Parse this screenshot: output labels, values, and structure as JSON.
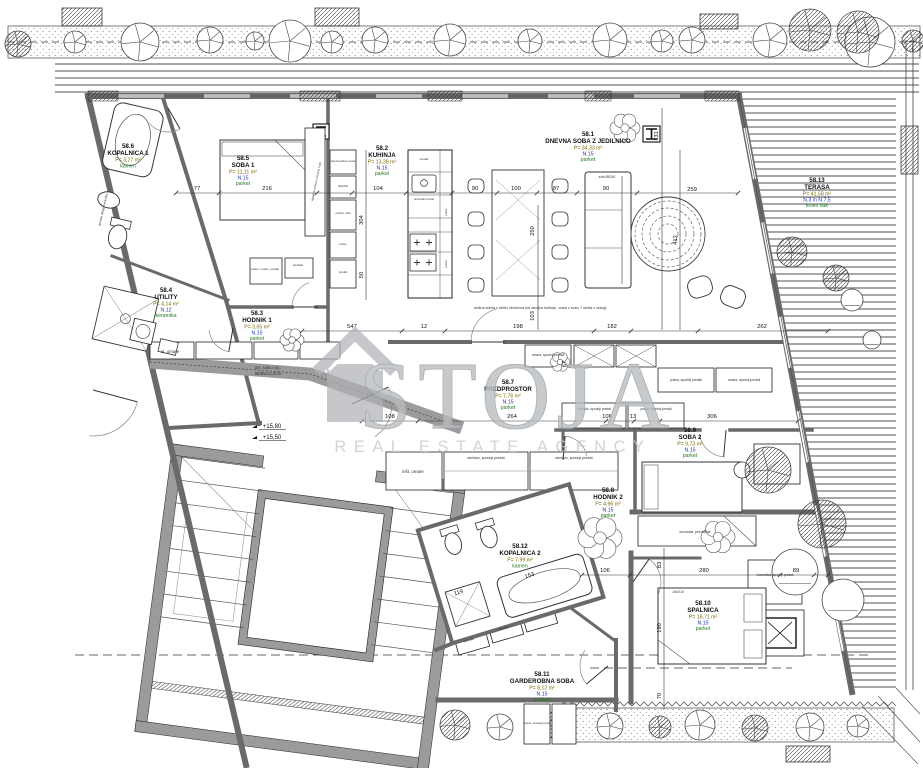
{
  "plan": {
    "watermark": {
      "brand": "STOJA",
      "tagline": "REAL ESTATE AGENCY"
    },
    "elevation_marks": [
      "+15,80",
      "+15,50"
    ],
    "rooms": [
      {
        "id": "58.1",
        "name": "DNEVNA SOBA Z JEDILNICO",
        "area": "P= 34,33 m²",
        "level": "N.15",
        "finish": "parket"
      },
      {
        "id": "58.2",
        "name": "KUHINJA",
        "area": "P= 13,38 m²",
        "level": "N.15",
        "finish": "parket"
      },
      {
        "id": "58.3",
        "name": "HODNIK 1",
        "area": "P= 3,65 m²",
        "level": "N.15",
        "finish": "parket"
      },
      {
        "id": "58.4",
        "name": "UTILITY",
        "area": "P= 4,14 m²",
        "level": "N.12",
        "finish": "keramika"
      },
      {
        "id": "58.5",
        "name": "SOBA 1",
        "area": "P= 11,11 m²",
        "level": "N.15",
        "finish": "parket"
      },
      {
        "id": "58.6",
        "name": "KOPALNICA 1",
        "area": "P= 3,27 m²",
        "level": "",
        "finish": "kamen"
      },
      {
        "id": "58.7",
        "name": "PREDPROSTOR",
        "area": "P= 7,76 m²",
        "level": "N.15",
        "finish": "parket"
      },
      {
        "id": "58.8",
        "name": "HODNIK 2",
        "area": "P= 4,96 m²",
        "level": "N.15",
        "finish": "parket"
      },
      {
        "id": "58.9",
        "name": "SOBA 2",
        "area": "P= 9,73 m²",
        "level": "N.15",
        "finish": "parket"
      },
      {
        "id": "58.10",
        "name": "SPALNICA",
        "area": "P= 16,71 m²",
        "level": "N.15",
        "finish": "parket"
      },
      {
        "id": "58.11",
        "name": "GARDEROBNA SOBA",
        "area": "P= 8,12 m²",
        "level": "N.15",
        "finish": "parket"
      },
      {
        "id": "58.12",
        "name": "KOPALNICA 2",
        "area": "P= 7,99 m²",
        "level": "",
        "finish": "kamen"
      },
      {
        "id": "58.13",
        "name": "TERASA",
        "area": "P= 41,58 m²",
        "level": "N.3 in N.7,5",
        "finish": "lesen tlak"
      }
    ],
    "dimensions": [
      "77",
      "216",
      "104",
      "90",
      "100",
      "87",
      "90",
      "259",
      "547",
      "12",
      "198",
      "182",
      "262",
      "108",
      "264",
      "106",
      "13",
      "306",
      "106",
      "280",
      "89",
      "304",
      "50",
      "131",
      "250",
      "103",
      "412",
      "67",
      "83",
      "190",
      "70",
      "119",
      "153"
    ],
    "annotations": [
      "el. omare",
      "om. talno og.:",
      "95/85/12,5cm",
      "inšt. omare",
      "obešalo, spodnji predali",
      "obešalo, spodnji predali",
      "obešalo, spodnji predal",
      "police, spodnji predal",
      "komoda, predalnik",
      "kozmetika, spodnji predali",
      "polica, spodaj predal",
      "omara, spodnji predali",
      "polica, spodnji predali",
      "omara, spodnji predali",
      "zamrzovalna omara",
      "hladilnik",
      "pečica, niša",
      "police",
      "predali",
      "pomivalno korito",
      "police",
      "police",
      "predali",
      "sofa 85/240",
      "160/210",
      "dvižna stena v obliki obložena kot okolica kuhinje, vrata v sobo 7 skrita v oblogi",
      "obešalo",
      "obešalo",
      "police, omare, predali",
      "obešalo",
      "vgradna omara z drsnimi vrati",
      "stenske obloge keramika"
    ],
    "colors": {
      "wall": "#6a6a6a",
      "line": "#3f3f3f",
      "text": "#111111",
      "area": "#7a6a00",
      "level": "#2236b0",
      "finish": "#1f7a1f",
      "watermark": "#b9bdc1"
    }
  }
}
